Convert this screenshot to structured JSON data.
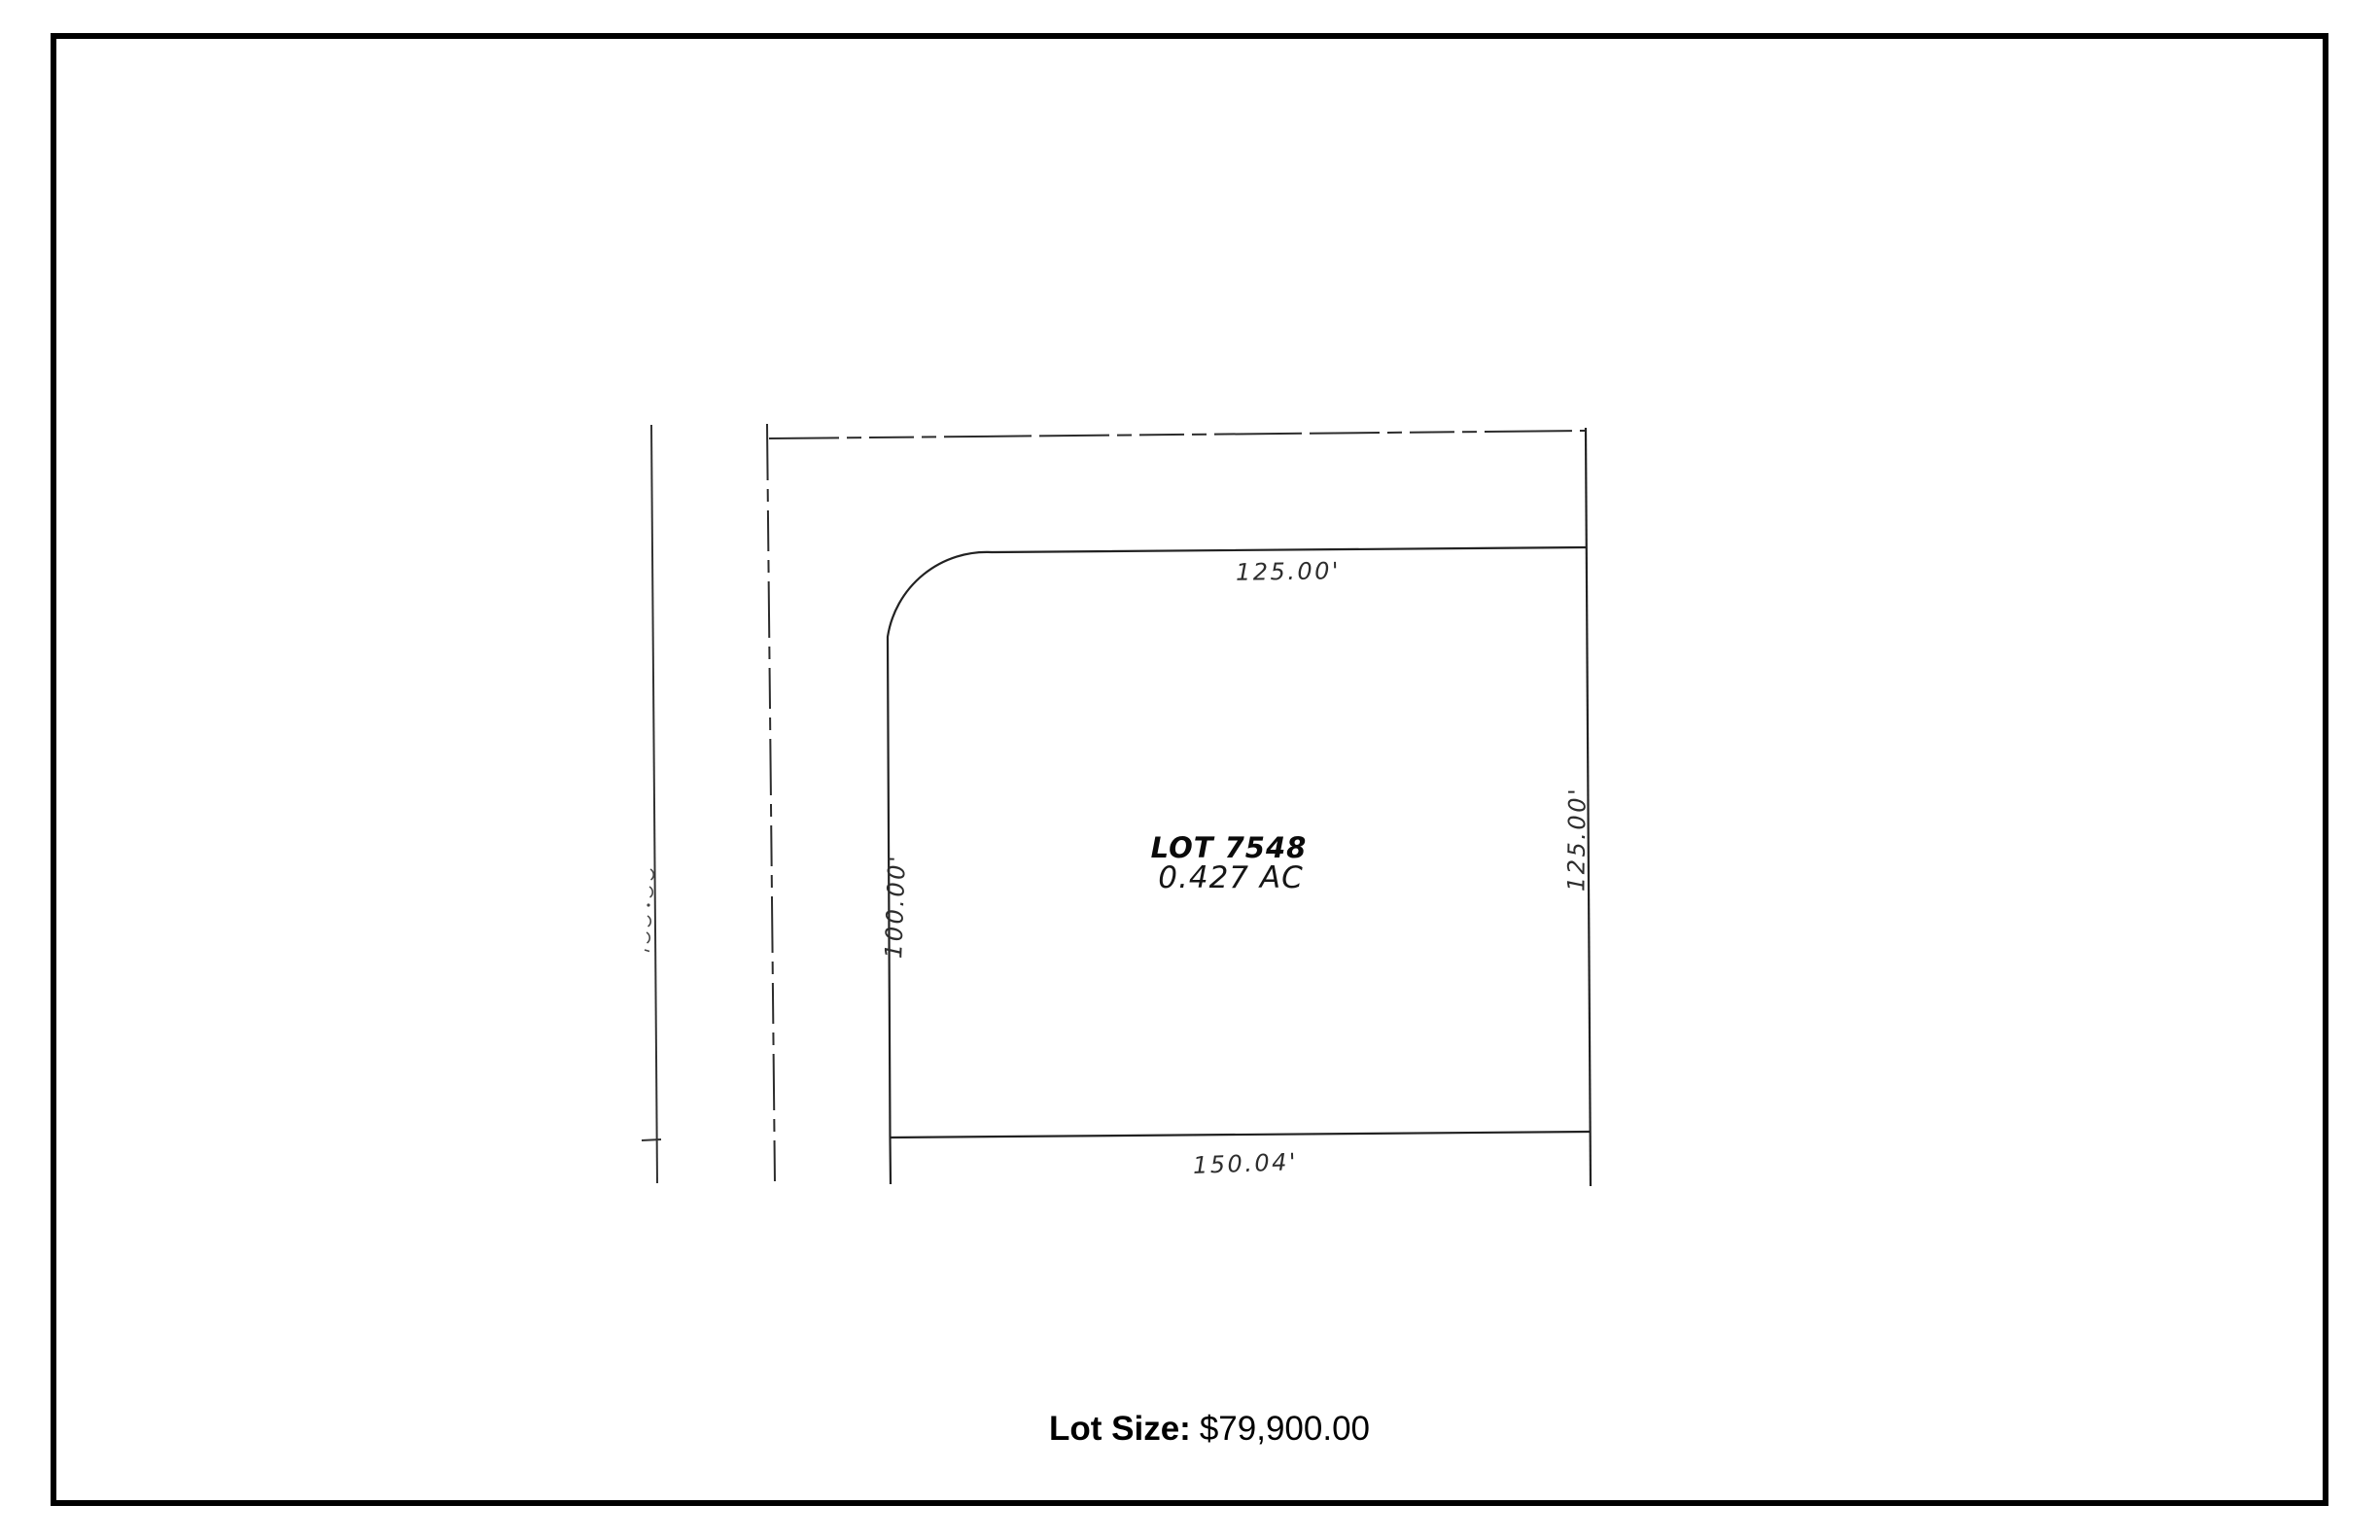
{
  "plat": {
    "lot_name": "LOT 7548",
    "lot_area": "0.427 AC",
    "dimensions": {
      "top": "125.00'",
      "right": "125.00'",
      "left": "100.00'",
      "bottom": "150.04'"
    }
  },
  "footer": {
    "label": "Lot Size:",
    "price": "$79,900.00"
  },
  "colors": {
    "background": "#ffffff",
    "border": "#000000",
    "road_line": "#333333",
    "lot_line": "#222222",
    "dim_text": "#2d2d2d",
    "price_text": "#000000"
  }
}
